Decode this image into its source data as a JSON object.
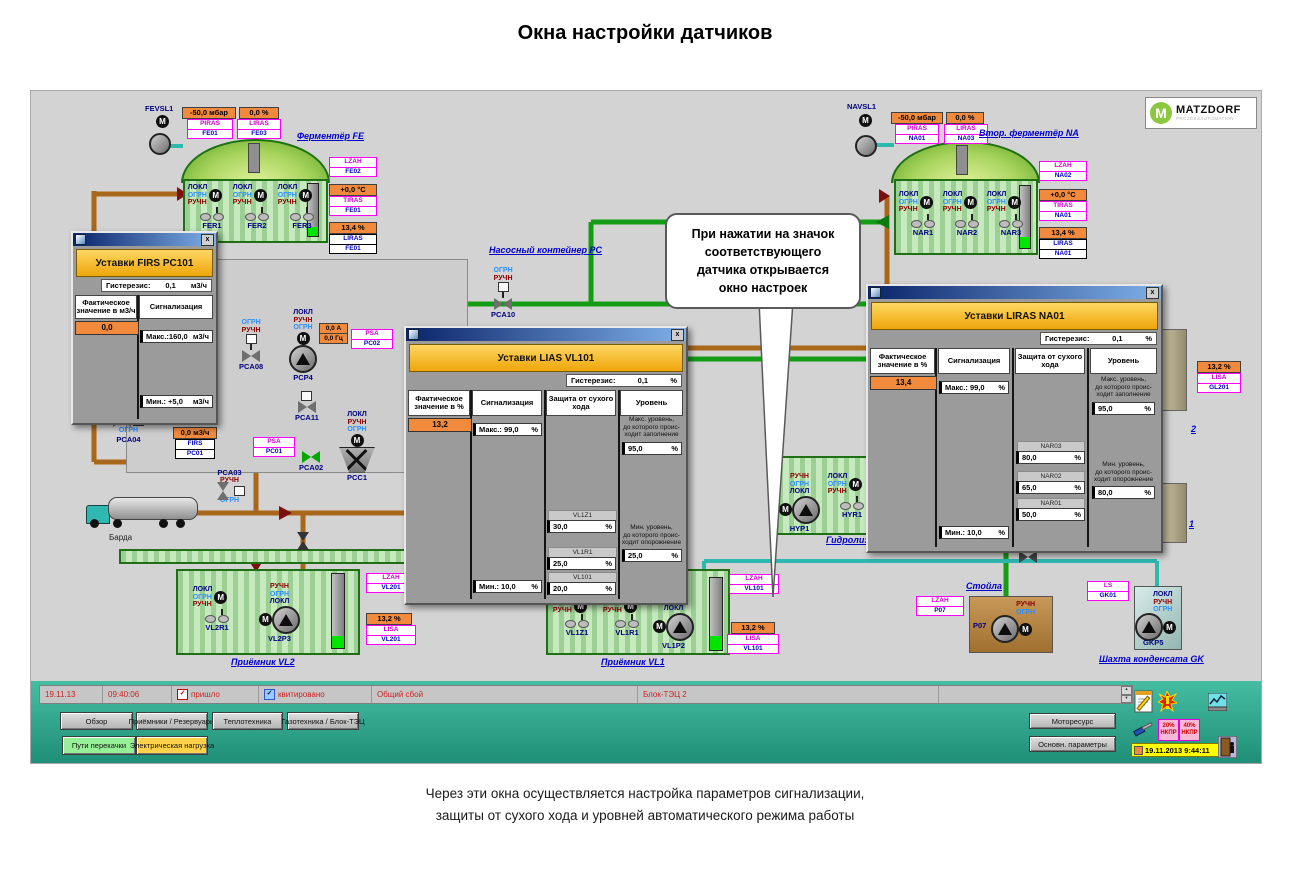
{
  "page": {
    "title": "Окна настройки датчиков",
    "caption1": "Через эти окна осуществляется настройка параметров сигнализации,",
    "caption2": "защиты от сухого хода и уровней автоматического режима работы"
  },
  "logo": {
    "m": "M",
    "brand": "MATZDORF",
    "sub": "PROZESSAUTOMATION"
  },
  "icons": {
    "motor": "M",
    "close": "x",
    "check": "✓",
    "up": "▲",
    "down": "▼"
  },
  "sw": {
    "lokl": "ЛОКЛ",
    "ogrn": "ОГРН",
    "ruchn": "РУЧН"
  },
  "callout": {
    "l1": "При нажатии на значок",
    "l2": "соответствующего",
    "l3": "датчика открывается",
    "l4": "окно  настроек"
  },
  "fe": {
    "title": "Ферментёр FE",
    "motor": "FEVSL1",
    "press": "-50,0  мбар",
    "press1": "PIRAS",
    "press2": "FE01",
    "gas": "0,0  %",
    "gas1": "LIRAS",
    "gas2": "FE03",
    "lzah1": "LZAH",
    "lzah2": "FE02",
    "temp": "+0,0  °C",
    "temp1": "TIRAS",
    "temp2": "FE01",
    "lvl": "13,4  %",
    "lvl1": "LIRAS",
    "lvl2": "FE01",
    "mixers": [
      "FER1",
      "FER2",
      "FER3"
    ]
  },
  "na": {
    "title": "Втор. ферментёр NA",
    "motor": "NAVSL1",
    "press": "-50,0  мбар",
    "press1": "PIRAS",
    "press2": "NA01",
    "gas": "0,0  %",
    "gas1": "LIRAS",
    "gas2": "NA03",
    "lzah1": "LZAH",
    "lzah2": "NA02",
    "temp": "+0,0  °C",
    "temp1": "TIRAS",
    "temp2": "NA01",
    "lvl": "13,4  %",
    "lvl1": "LIRAS",
    "lvl2": "NA01",
    "mixers": [
      "NAR1",
      "NAR2",
      "NAR3"
    ]
  },
  "pc": {
    "title": "Насосный контейнер PC",
    "pca10": "PCA10",
    "pca06": "PCA06",
    "pca08": "PCA08",
    "pcp4": "PCP4",
    "amp": "0,0  А",
    "hz": "0,0  Гц",
    "psa2a": "PSA",
    "psa2b": "PC02",
    "pca11": "PCA11",
    "pca04": "PCA04",
    "flow": "0,0  м3/ч",
    "firsa": "FIRS",
    "firsb": "PC01",
    "psa1a": "PSA",
    "psa1b": "PC01",
    "pca03": "PCA03",
    "pca02": "PCA02",
    "pcc1": "PCC1"
  },
  "truck": {
    "label": "Барда"
  },
  "vl2": {
    "title": "Приёмник VL2",
    "mixer": "VL2R1",
    "pump": "VL2P3",
    "lzah1": "LZAH",
    "lzah2": "VL201",
    "lvl": "13,2  %",
    "lisa1": "LISA",
    "lisa2": "VL201"
  },
  "vl1": {
    "title": "Приёмник VL1",
    "mix1": "VL1Z1",
    "mix2": "VL1R1",
    "pump": "VL1P2",
    "lzah1": "LZAH",
    "lzah2": "VL101",
    "lvl": "13,2  %",
    "lisa1": "LISA",
    "lisa2": "VL101"
  },
  "hy": {
    "title": "Гидролиз",
    "pump": "HYP1",
    "mixer": "HYR1"
  },
  "st": {
    "title": "Стойла",
    "pump": "P07",
    "lzah1": "LZAH",
    "lzah2": "P07"
  },
  "gk": {
    "title": "Шахта конденсата GK",
    "pump": "GKP5",
    "ls1": "LS",
    "ls2": "GK01"
  },
  "rt": {
    "t2": "2",
    "t1": "1",
    "lvl": "13,2  %",
    "lisa1": "LISA",
    "lisa2": "GL201"
  },
  "d1": {
    "title": "Уставки FIRS PC101",
    "hyst_label": "Гистерезис:",
    "hyst_val": "0,1",
    "hyst_unit": "м3/ч",
    "col1": "Фактическое значение в м3/ч",
    "actual": "0,0",
    "col2": "Сигнализация",
    "max": "Макс.:160,0",
    "max_unit": "м3/ч",
    "min": "Мин.:  +5,0",
    "min_unit": "м3/ч"
  },
  "d2": {
    "title": "Уставки LIAS VL101",
    "hyst_label": "Гистерезис:",
    "hyst_val": "0,1",
    "hyst_unit": "%",
    "col1": "Фактическое значение в %",
    "actual": "13,2",
    "col2": "Сигнализация",
    "max": "Макс.: 99,0",
    "min": "Мин.:  10,0",
    "pct": "%",
    "col3": "Защита от сухого хода",
    "dry": [
      {
        "tag": "VL1Z1",
        "val": "30,0"
      },
      {
        "tag": "VL1R1",
        "val": "25,0"
      },
      {
        "tag": "VL101",
        "val": "20,0"
      }
    ],
    "col4": "Уровень",
    "maxn1": "Макс. уровень,",
    "maxn2": "до которого проис-",
    "maxn3": "ходит заполнение",
    "maxv": "95,0",
    "minn1": "Мин. уровень,",
    "minn2": "до которого проис-",
    "minn3": "ходит опорожнение",
    "minv": "25,0"
  },
  "d3": {
    "title": "Уставки LIRAS NA01",
    "hyst_label": "Гистерезис:",
    "hyst_val": "0,1",
    "hyst_unit": "%",
    "col1": "Фактическое значение в %",
    "actual": "13,4",
    "col2": "Сигнализация",
    "max": "Макс.: 99,0",
    "min": "Мин.:  10,0",
    "pct": "%",
    "col3": "Защита от сухого хода",
    "dry": [
      {
        "tag": "NAR03",
        "val": "80,0"
      },
      {
        "tag": "NAR02",
        "val": "65,0"
      },
      {
        "tag": "NAR01",
        "val": "50,0"
      }
    ],
    "col4": "Уровень",
    "maxn1": "Макс. уровень,",
    "maxn2": "до которого проис-",
    "maxn3": "ходит заполнение",
    "maxv": "95,0",
    "minn1": "Мин. уровень,",
    "minn2": "до которого проис-",
    "minn3": "ходит опорожнение",
    "minv": "80,0"
  },
  "sb": {
    "date": "19.11.13",
    "time": "09:40:06",
    "came": "пришло",
    "ack": "квитировано",
    "alarm": "Общий сбой",
    "unit": "Блок-ТЭЦ 2"
  },
  "tb": {
    "b1": "Обзор",
    "b2": "Приёмники / Резервуары",
    "b3": "Теплотехника",
    "b4": "Газотехника / Блок-ТЭЦ",
    "b5": "Пути перекачки",
    "b6": "Электрическая нагрузка",
    "b7": "Моторесурс",
    "b8": "Основн. параметры",
    "badge1a": "20%",
    "badge1b": "НКПР",
    "badge2a": "40%",
    "badge2b": "НКПР",
    "datetime": "19.11.2013 9:44:11"
  },
  "colors": {
    "toolbar_teal": "#2fa78e",
    "alarm_orange": "#f28a3d",
    "tag_magenta": "#ff00ff",
    "pipe_brown": "#a9671a",
    "pipe_green": "#149c14",
    "pipe_teal": "#2db8b0"
  }
}
